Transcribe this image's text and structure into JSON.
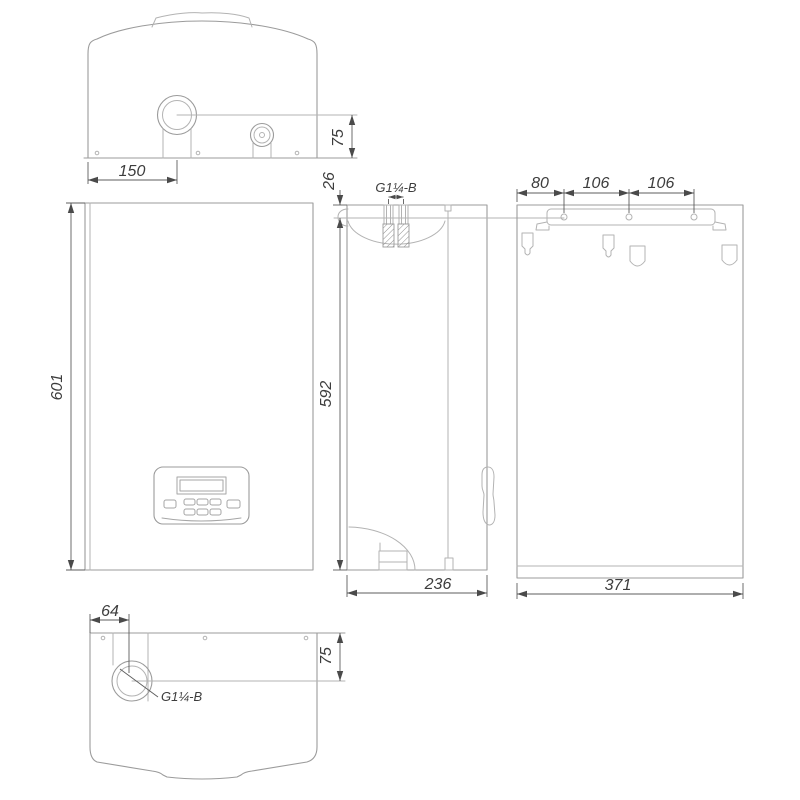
{
  "drawing": {
    "kind": "wall-hung boiler dimensional drawing",
    "background": "#ffffff",
    "outline_color": "#9b9b9b",
    "dimension_color": "#5c5c5c",
    "text_color": "#3d3d3d",
    "views": {
      "top": {
        "dim_flue_offset": "150",
        "dim_flue_depth": "75"
      },
      "front": {
        "dim_height": "601"
      },
      "side": {
        "dim_top_offset": "26",
        "dim_height": "592",
        "dim_depth": "236",
        "label_connection": "G1¼-B"
      },
      "back": {
        "dim_hole_left": "80",
        "dim_hole_mid": "106",
        "dim_hole_right": "106",
        "dim_width": "371"
      },
      "bottom": {
        "dim_pipe_offset": "64",
        "dim_pipe_depth": "75",
        "label_connection": "G1¼-B"
      }
    }
  }
}
